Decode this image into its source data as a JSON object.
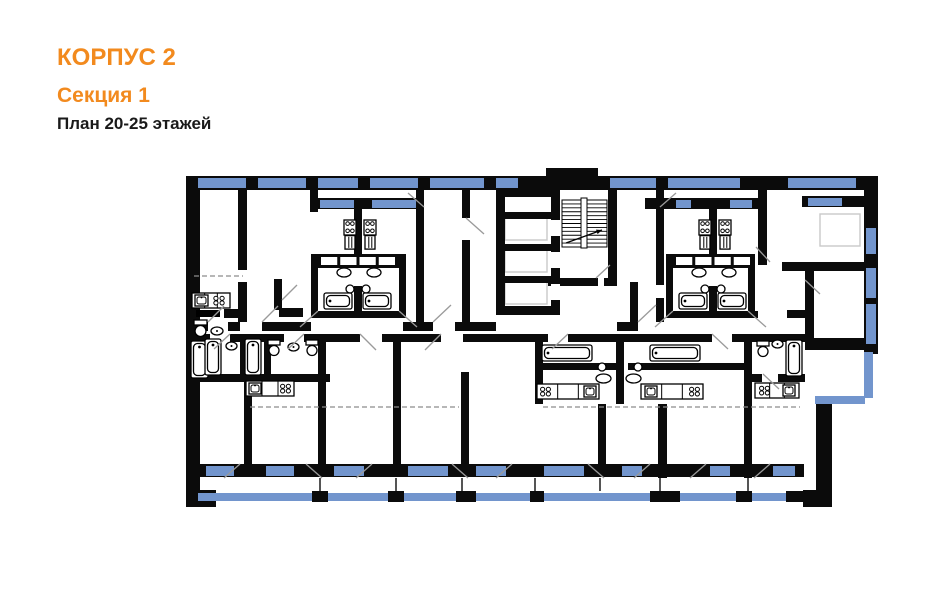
{
  "header": {
    "building": "КОРПУС 2",
    "section": "Секция 1",
    "plan_label": "План 20-25 этажей"
  },
  "palette": {
    "accent": "#F28A1E",
    "wall": "#0B0B0B",
    "window": "#7295CD",
    "door": "#9A9A9A",
    "dash": "#8C8C8C",
    "pale": "#C9C9C9",
    "text": "#1A1A1A",
    "bg": "#FFFFFF"
  },
  "plan": {
    "walls": [
      [
        186,
        176,
        692,
        14
      ],
      [
        186,
        176,
        14,
        331
      ],
      [
        546,
        168,
        52,
        9
      ],
      [
        864,
        176,
        14,
        178
      ],
      [
        805,
        338,
        73,
        12
      ],
      [
        816,
        396,
        16,
        111
      ],
      [
        803,
        490,
        28,
        17
      ],
      [
        186,
        490,
        30,
        17
      ],
      [
        200,
        464,
        604,
        13
      ],
      [
        186,
        250,
        9,
        10
      ],
      [
        496,
        188,
        64,
        9
      ],
      [
        496,
        188,
        9,
        127
      ],
      [
        551,
        188,
        9,
        127
      ],
      [
        501,
        212,
        50,
        7
      ],
      [
        501,
        244,
        50,
        7
      ],
      [
        501,
        276,
        50,
        7
      ],
      [
        496,
        306,
        64,
        9
      ],
      [
        551,
        176,
        9,
        14
      ],
      [
        608,
        176,
        9,
        109
      ],
      [
        548,
        278,
        50,
        8
      ],
      [
        604,
        278,
        13,
        8
      ],
      [
        630,
        282,
        8,
        42
      ],
      [
        238,
        190,
        9,
        80
      ],
      [
        238,
        282,
        9,
        40
      ],
      [
        310,
        190,
        8,
        22
      ],
      [
        416,
        190,
        8,
        22
      ],
      [
        354,
        207,
        8,
        50
      ],
      [
        354,
        286,
        8,
        25
      ],
      [
        416,
        212,
        8,
        110
      ],
      [
        462,
        190,
        8,
        28
      ],
      [
        462,
        240,
        8,
        82
      ],
      [
        656,
        190,
        8,
        95
      ],
      [
        656,
        298,
        8,
        24
      ],
      [
        709,
        207,
        8,
        50
      ],
      [
        709,
        286,
        8,
        25
      ],
      [
        758,
        190,
        9,
        75
      ],
      [
        805,
        262,
        9,
        80
      ],
      [
        782,
        262,
        96,
        9
      ],
      [
        787,
        310,
        18,
        8
      ],
      [
        802,
        196,
        62,
        11
      ],
      [
        312,
        198,
        112,
        11
      ],
      [
        317,
        254,
        82,
        14
      ],
      [
        311,
        254,
        7,
        64
      ],
      [
        399,
        254,
        7,
        64
      ],
      [
        314,
        311,
        89,
        7
      ],
      [
        645,
        198,
        114,
        11
      ],
      [
        672,
        254,
        82,
        14
      ],
      [
        666,
        254,
        7,
        64
      ],
      [
        748,
        254,
        7,
        64
      ],
      [
        669,
        311,
        89,
        7
      ],
      [
        200,
        322,
        8,
        9
      ],
      [
        228,
        322,
        12,
        9
      ],
      [
        262,
        322,
        49,
        9
      ],
      [
        403,
        322,
        30,
        9
      ],
      [
        455,
        322,
        41,
        9
      ],
      [
        617,
        322,
        21,
        9
      ],
      [
        274,
        279,
        8,
        31
      ],
      [
        279,
        308,
        24,
        9
      ],
      [
        224,
        309,
        19,
        9
      ],
      [
        200,
        334,
        10,
        8
      ],
      [
        230,
        334,
        54,
        8
      ],
      [
        304,
        334,
        26,
        8
      ],
      [
        240,
        342,
        7,
        33
      ],
      [
        264,
        342,
        7,
        33
      ],
      [
        200,
        374,
        130,
        8
      ],
      [
        244,
        382,
        8,
        82
      ],
      [
        318,
        342,
        8,
        122
      ],
      [
        330,
        334,
        30,
        8
      ],
      [
        382,
        334,
        19,
        8
      ],
      [
        401,
        334,
        40,
        8
      ],
      [
        463,
        334,
        72,
        8
      ],
      [
        393,
        334,
        8,
        130
      ],
      [
        461,
        372,
        8,
        92
      ],
      [
        535,
        334,
        13,
        8
      ],
      [
        568,
        334,
        144,
        8
      ],
      [
        732,
        334,
        13,
        8
      ],
      [
        535,
        334,
        8,
        70
      ],
      [
        616,
        334,
        8,
        70
      ],
      [
        744,
        334,
        8,
        70
      ],
      [
        535,
        363,
        85,
        7
      ],
      [
        628,
        363,
        117,
        7
      ],
      [
        598,
        404,
        8,
        60
      ],
      [
        658,
        404,
        9,
        74
      ],
      [
        744,
        404,
        8,
        74
      ],
      [
        752,
        334,
        53,
        8
      ],
      [
        752,
        374,
        10,
        8
      ],
      [
        778,
        374,
        27,
        8
      ]
    ],
    "windows": [
      [
        198,
        178,
        48,
        10
      ],
      [
        258,
        178,
        48,
        10
      ],
      [
        318,
        178,
        40,
        10
      ],
      [
        370,
        178,
        48,
        10
      ],
      [
        430,
        178,
        54,
        10
      ],
      [
        496,
        178,
        22,
        10
      ],
      [
        610,
        178,
        46,
        10
      ],
      [
        668,
        178,
        72,
        10
      ],
      [
        788,
        178,
        68,
        10
      ],
      [
        320,
        200,
        34,
        8
      ],
      [
        372,
        200,
        44,
        8
      ],
      [
        676,
        200,
        15,
        8
      ],
      [
        730,
        200,
        22,
        8
      ],
      [
        808,
        198,
        34,
        8
      ],
      [
        866,
        228,
        10,
        26
      ],
      [
        866,
        268,
        10,
        30
      ],
      [
        866,
        304,
        10,
        40
      ],
      [
        206,
        466,
        28,
        10
      ],
      [
        266,
        466,
        28,
        10
      ],
      [
        334,
        466,
        30,
        10
      ],
      [
        408,
        466,
        40,
        10
      ],
      [
        476,
        466,
        30,
        10
      ],
      [
        544,
        466,
        40,
        10
      ],
      [
        622,
        466,
        20,
        10
      ],
      [
        710,
        466,
        20,
        10
      ],
      [
        773,
        466,
        22,
        10
      ]
    ],
    "rails": [
      [
        198,
        493,
        605,
        8
      ],
      [
        864,
        352,
        9,
        46
      ],
      [
        815,
        396,
        50,
        8
      ]
    ],
    "posts": [
      [
        312,
        491,
        16,
        11
      ],
      [
        388,
        491,
        16,
        11
      ],
      [
        456,
        491,
        20,
        11
      ],
      [
        530,
        491,
        14,
        11
      ],
      [
        650,
        491,
        30,
        11
      ],
      [
        736,
        491,
        16,
        11
      ],
      [
        786,
        491,
        18,
        11
      ]
    ],
    "gaps": [
      [
        551,
        220,
        9,
        16
      ],
      [
        551,
        252,
        9,
        16
      ],
      [
        551,
        284,
        9,
        16
      ]
    ],
    "pale_rects": [
      [
        505,
        218,
        42,
        22
      ],
      [
        505,
        250,
        42,
        22
      ],
      [
        505,
        282,
        42,
        22
      ],
      [
        820,
        214,
        40,
        32
      ]
    ],
    "balcony_dividers": [
      320,
      396,
      462,
      535,
      600,
      660,
      748
    ],
    "dashes": [
      [
        194,
        276,
        243,
        276
      ],
      [
        250,
        407,
        459,
        407
      ],
      [
        543,
        407,
        800,
        407
      ]
    ],
    "doors": [
      [
        208,
        322,
        224,
        306
      ],
      [
        262,
        322,
        278,
        306
      ],
      [
        433,
        322,
        451,
        305
      ],
      [
        466,
        218,
        484,
        234
      ],
      [
        638,
        322,
        656,
        305
      ],
      [
        770,
        262,
        756,
        247
      ],
      [
        805,
        280,
        820,
        294
      ],
      [
        318,
        311,
        300,
        327
      ],
      [
        399,
        311,
        417,
        327
      ],
      [
        673,
        311,
        655,
        327
      ],
      [
        748,
        311,
        766,
        327
      ],
      [
        230,
        334,
        214,
        349
      ],
      [
        304,
        334,
        288,
        349
      ],
      [
        568,
        334,
        552,
        349
      ],
      [
        712,
        334,
        728,
        349
      ],
      [
        360,
        334,
        376,
        350
      ],
      [
        441,
        334,
        425,
        350
      ],
      [
        763,
        374,
        779,
        389
      ],
      [
        282,
        300,
        297,
        285
      ],
      [
        424,
        207,
        408,
        193
      ],
      [
        660,
        207,
        676,
        193
      ],
      [
        596,
        278,
        610,
        265
      ],
      [
        240,
        464,
        224,
        478
      ],
      [
        306,
        464,
        322,
        478
      ],
      [
        372,
        464,
        356,
        478
      ],
      [
        452,
        464,
        468,
        478
      ],
      [
        512,
        464,
        496,
        478
      ],
      [
        588,
        464,
        604,
        478
      ],
      [
        650,
        464,
        634,
        478
      ],
      [
        706,
        464,
        690,
        478
      ],
      [
        770,
        464,
        754,
        478
      ]
    ],
    "stair": {
      "x": 562,
      "y": 200,
      "w": 45,
      "h": 47,
      "steps": 12,
      "stringer": [
        581,
        198,
        6,
        50
      ],
      "arrow": [
        566,
        243,
        602,
        230
      ]
    },
    "fixtures": [
      {
        "t": "counter",
        "x": 192,
        "y": 293,
        "w": 38,
        "h": 15
      },
      {
        "t": "sinkbox",
        "x": 195,
        "y": 295,
        "w": 13,
        "h": 11
      },
      {
        "t": "burners",
        "x": 212,
        "y": 295,
        "w": 14,
        "h": 11
      },
      {
        "t": "bar",
        "x": 196,
        "y": 310,
        "w": 24,
        "h": 7
      },
      {
        "t": "wc",
        "x": 194,
        "y": 320,
        "w": 13,
        "h": 17
      },
      {
        "t": "basin",
        "x": 211,
        "y": 327,
        "w": 12,
        "h": 8
      },
      {
        "t": "tubv",
        "x": 191,
        "y": 341,
        "w": 17,
        "h": 37
      },
      {
        "t": "tubv",
        "x": 205,
        "y": 339,
        "w": 16,
        "h": 36
      },
      {
        "t": "basin",
        "x": 226,
        "y": 342,
        "w": 11,
        "h": 8
      },
      {
        "t": "tubv",
        "x": 245,
        "y": 339,
        "w": 16,
        "h": 36
      },
      {
        "t": "wc",
        "x": 268,
        "y": 340,
        "w": 12,
        "h": 16
      },
      {
        "t": "basin",
        "x": 288,
        "y": 343,
        "w": 11,
        "h": 8
      },
      {
        "t": "wc",
        "x": 306,
        "y": 340,
        "w": 12,
        "h": 16
      },
      {
        "t": "counter",
        "x": 246,
        "y": 381,
        "w": 48,
        "h": 15
      },
      {
        "t": "sinkbox",
        "x": 249,
        "y": 383,
        "w": 12,
        "h": 11
      },
      {
        "t": "burners",
        "x": 279,
        "y": 383,
        "w": 13,
        "h": 11
      },
      {
        "t": "stove",
        "x": 344,
        "y": 220,
        "w": 12,
        "h": 30
      },
      {
        "t": "stove",
        "x": 364,
        "y": 220,
        "w": 12,
        "h": 30
      },
      {
        "t": "cells4",
        "x": 321,
        "y": 257,
        "w": 74,
        "h": 8
      },
      {
        "t": "oval",
        "x": 337,
        "y": 268,
        "w": 14,
        "h": 9
      },
      {
        "t": "oval",
        "x": 367,
        "y": 268,
        "w": 14,
        "h": 9
      },
      {
        "t": "circle",
        "x": 350,
        "y": 289,
        "r": 4
      },
      {
        "t": "circle",
        "x": 366,
        "y": 289,
        "r": 4
      },
      {
        "t": "tubh",
        "x": 324,
        "y": 293,
        "w": 28,
        "h": 16
      },
      {
        "t": "tubh",
        "x": 363,
        "y": 293,
        "w": 28,
        "h": 16
      },
      {
        "t": "stove",
        "x": 699,
        "y": 220,
        "w": 12,
        "h": 30
      },
      {
        "t": "stove",
        "x": 719,
        "y": 220,
        "w": 12,
        "h": 30
      },
      {
        "t": "cells4",
        "x": 676,
        "y": 257,
        "w": 74,
        "h": 8
      },
      {
        "t": "oval",
        "x": 692,
        "y": 268,
        "w": 14,
        "h": 9
      },
      {
        "t": "oval",
        "x": 722,
        "y": 268,
        "w": 14,
        "h": 9
      },
      {
        "t": "circle",
        "x": 705,
        "y": 289,
        "r": 4
      },
      {
        "t": "circle",
        "x": 721,
        "y": 289,
        "r": 4
      },
      {
        "t": "tubh",
        "x": 679,
        "y": 293,
        "w": 28,
        "h": 16
      },
      {
        "t": "tubh",
        "x": 718,
        "y": 293,
        "w": 28,
        "h": 16
      },
      {
        "t": "tubh",
        "x": 542,
        "y": 345,
        "w": 50,
        "h": 16
      },
      {
        "t": "tubh",
        "x": 650,
        "y": 345,
        "w": 50,
        "h": 16
      },
      {
        "t": "circle",
        "x": 602,
        "y": 367,
        "r": 4
      },
      {
        "t": "circle",
        "x": 638,
        "y": 367,
        "r": 4
      },
      {
        "t": "oval",
        "x": 596,
        "y": 374,
        "w": 15,
        "h": 9
      },
      {
        "t": "oval",
        "x": 626,
        "y": 374,
        "w": 15,
        "h": 9
      },
      {
        "t": "counter",
        "x": 537,
        "y": 384,
        "w": 62,
        "h": 15
      },
      {
        "t": "burners",
        "x": 539,
        "y": 386,
        "w": 13,
        "h": 11
      },
      {
        "t": "sinkbox",
        "x": 584,
        "y": 386,
        "w": 12,
        "h": 11
      },
      {
        "t": "counter",
        "x": 641,
        "y": 384,
        "w": 62,
        "h": 15
      },
      {
        "t": "sinkbox",
        "x": 645,
        "y": 386,
        "w": 12,
        "h": 11
      },
      {
        "t": "burners",
        "x": 688,
        "y": 386,
        "w": 13,
        "h": 11
      },
      {
        "t": "wc",
        "x": 757,
        "y": 341,
        "w": 12,
        "h": 16
      },
      {
        "t": "basin",
        "x": 772,
        "y": 340,
        "w": 11,
        "h": 8
      },
      {
        "t": "tubv",
        "x": 786,
        "y": 340,
        "w": 16,
        "h": 36
      },
      {
        "t": "counter",
        "x": 755,
        "y": 383,
        "w": 44,
        "h": 15
      },
      {
        "t": "burners",
        "x": 758,
        "y": 385,
        "w": 13,
        "h": 11
      },
      {
        "t": "sinkbox",
        "x": 783,
        "y": 385,
        "w": 12,
        "h": 11
      }
    ]
  }
}
